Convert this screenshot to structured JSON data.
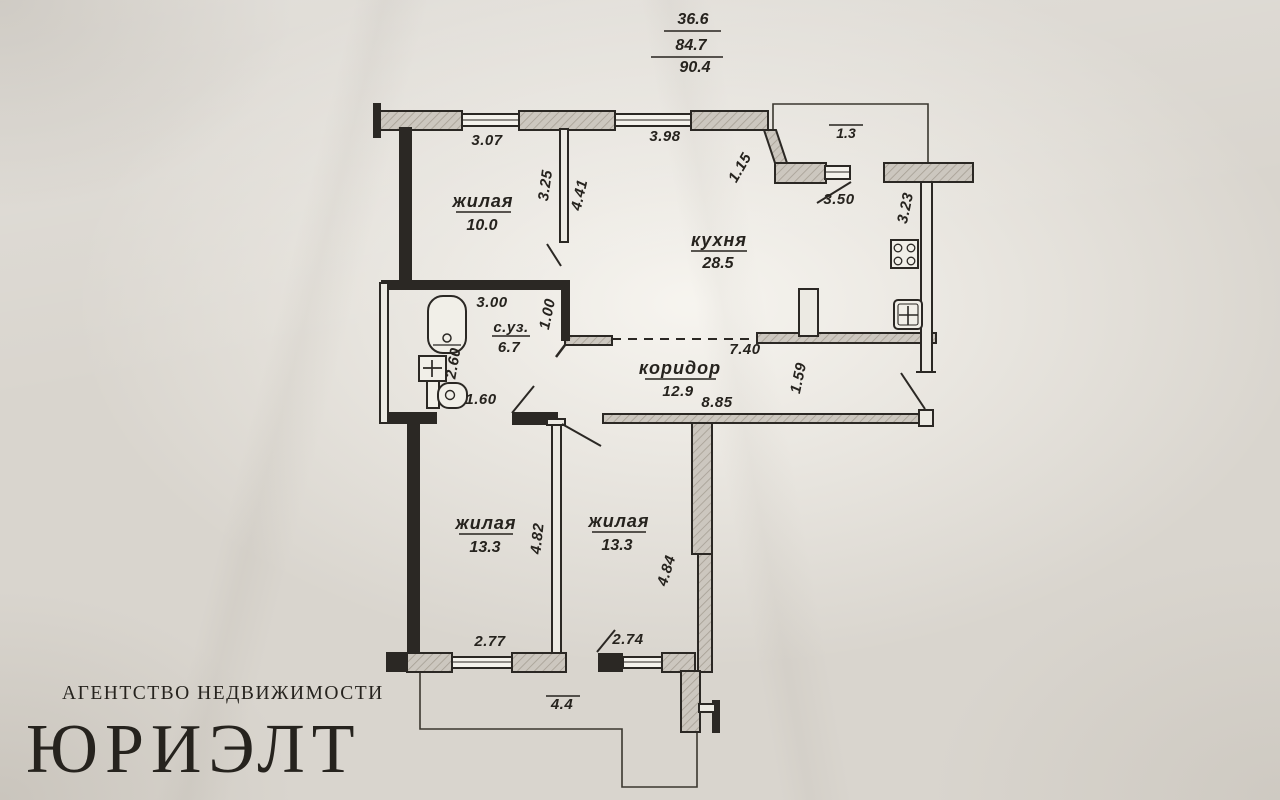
{
  "areas_summary": {
    "living": "36.6",
    "total": "84.7",
    "total_with_balcony": "90.4"
  },
  "rooms": {
    "room1": {
      "name": "жилая",
      "area": "10.0"
    },
    "kitchen": {
      "name": "кухня",
      "area": "28.5"
    },
    "bathroom": {
      "name": "с.уз.",
      "area": "6.7"
    },
    "corridor": {
      "name": "коридор",
      "area": "12.9"
    },
    "room2": {
      "name": "жилая",
      "area": "13.3"
    },
    "room3": {
      "name": "жилая",
      "area": "13.3"
    }
  },
  "dimensions": {
    "top_room1": "3.07",
    "top_kitchen": "3.98",
    "kitchen_wall_diag": "1.15",
    "balcony_top": "1.3",
    "room1_width": "3.25",
    "room1_depth": "4.41",
    "kitchen_balcony_wall": "3.50",
    "kitchen_right_wall": "3.23",
    "bathroom_width": "3.00",
    "kitchen_entry": "1.00",
    "bathroom_depth": "2.60",
    "bathroom_door": "1.60",
    "corridor_top": "7.40",
    "corridor_width": "1.59",
    "corridor_bottom": "8.85",
    "room2_depth": "4.82",
    "room3_depth": "4.84",
    "room2_window": "2.77",
    "room3_window": "2.74",
    "balcony_bottom": "4.4"
  },
  "logo": {
    "tagline": "АГЕНТСТВО НЕДВИЖИМОСТИ",
    "name": "ЮРИЭЛТ"
  },
  "colors": {
    "logo_red": "#8f1d29",
    "ink": "#26231e",
    "paper": "#d9d5ce"
  }
}
